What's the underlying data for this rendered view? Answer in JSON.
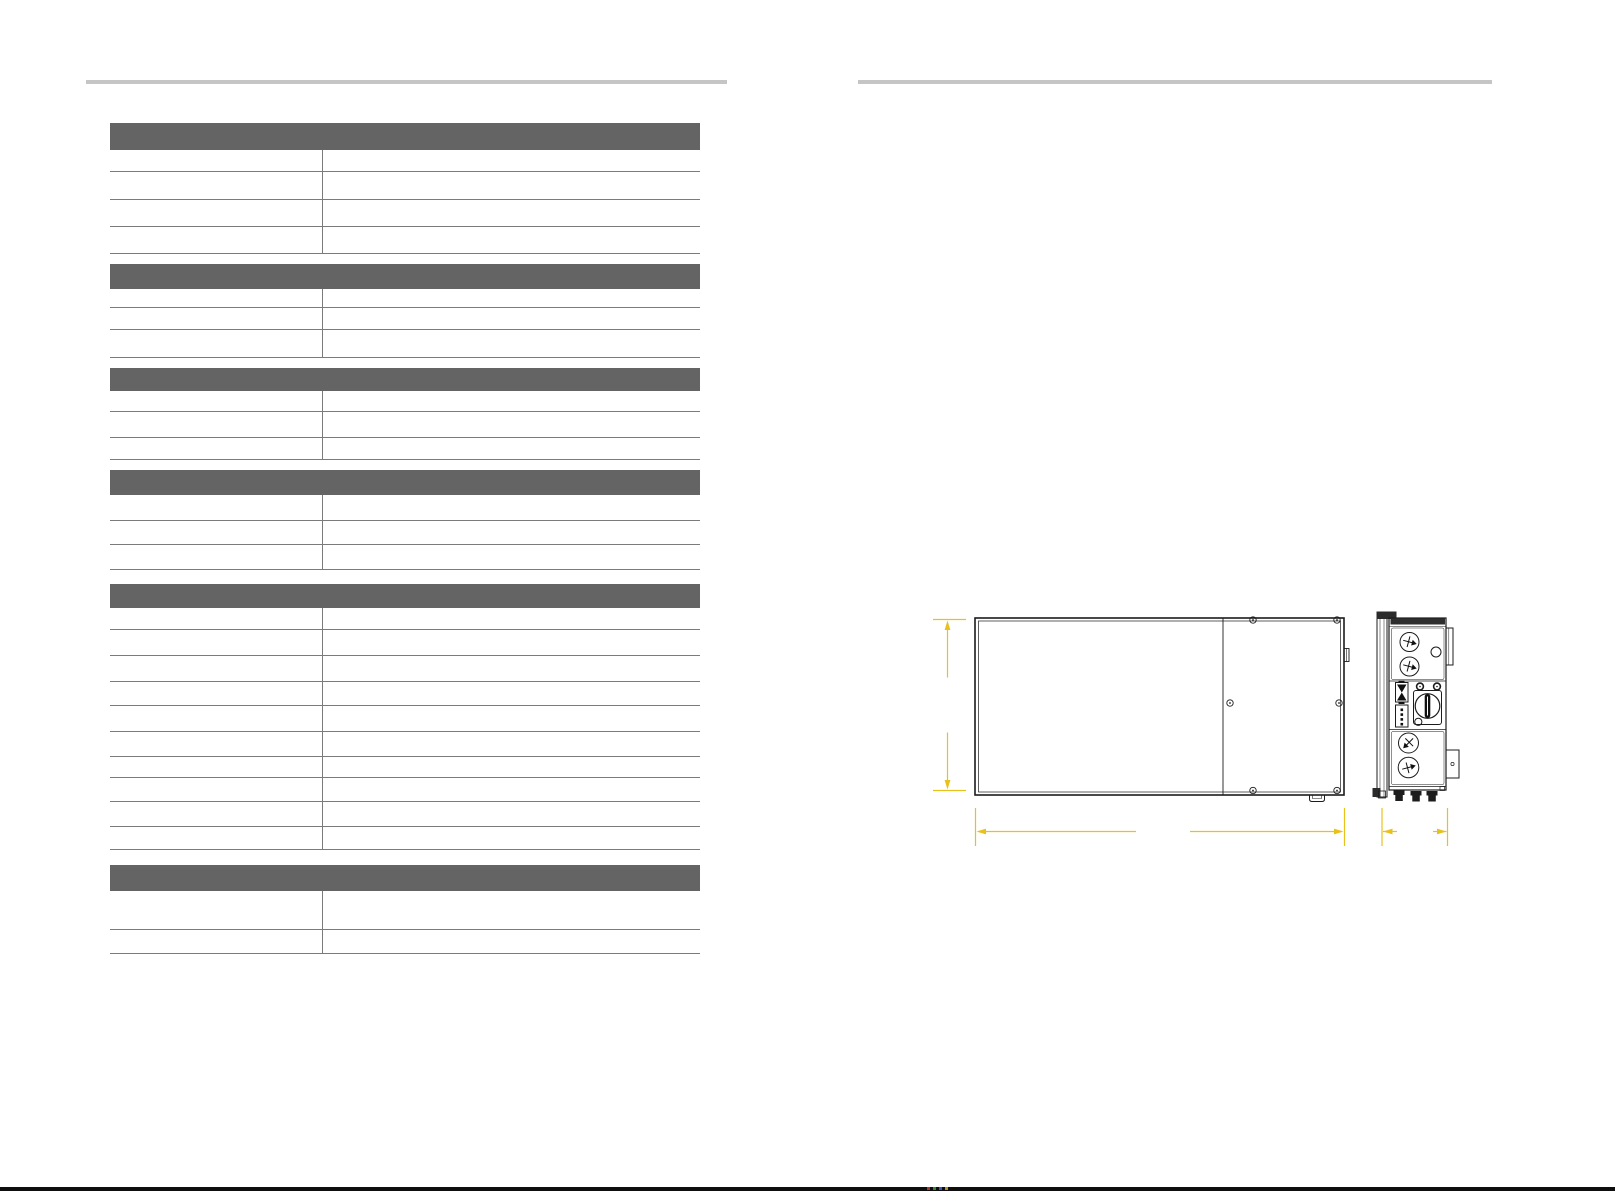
{
  "document": {
    "kind": "product-manual-two-page-spread",
    "visible_text": [],
    "note": "specification table cells are blank (no rendered text); right page shows dimensioned technical drawing"
  },
  "colors": {
    "page_background": "#ffffff",
    "section_bar": "#646464",
    "table_line": "#7b7b7b",
    "page_rule": "#c5c5c5",
    "drawing_stroke": "#1c1c1c",
    "dimension_yellow": "#e9c11b",
    "footer_bar": "#0e0e0e"
  },
  "left_page": {
    "top_rule": {
      "x": 86,
      "y": 80,
      "width": 641
    },
    "table": {
      "x": 110,
      "top": 123,
      "width": 590,
      "divider_offset": 212,
      "sections": [
        {
          "header_height": 27,
          "row_heights": [
            22,
            28,
            27,
            27
          ],
          "gap_below": 10
        },
        {
          "header_height": 25,
          "row_heights": [
            19,
            22,
            28
          ],
          "gap_below": 10
        },
        {
          "header_height": 23,
          "row_heights": [
            21,
            26,
            22
          ],
          "gap_below": 10
        },
        {
          "header_height": 25,
          "row_heights": [
            26,
            24,
            25
          ],
          "gap_below": 14
        },
        {
          "header_height": 24,
          "row_heights": [
            22,
            26,
            26,
            24,
            26,
            25,
            21,
            24,
            25,
            23
          ],
          "gap_below": 15
        },
        {
          "header_height": 26,
          "row_heights": [
            39,
            24
          ],
          "gap_below": 0
        }
      ]
    }
  },
  "right_page": {
    "top_rule": {
      "x": 858,
      "y": 80,
      "width": 634
    },
    "drawing": {
      "views": [
        "front-view",
        "side-view"
      ],
      "front_view_parts": [
        "enclosure",
        "cover-split-line",
        "screws",
        "side-latch",
        "bottom-tab"
      ],
      "side_view_parts": [
        "mounting-rail",
        "body",
        "top-bracket",
        "bottom-bracket",
        "ac-ports",
        "dc-switch-handle",
        "dc-connector",
        "terminal-block",
        "cable-glands"
      ],
      "dimension_lines": [
        "height",
        "width",
        "depth"
      ]
    }
  },
  "footer": {
    "specks": [
      {
        "x": 927,
        "y": 1187,
        "color": "#b03333"
      },
      {
        "x": 933,
        "y": 1187,
        "color": "#2f8a34"
      },
      {
        "x": 939,
        "y": 1187,
        "color": "#3a55c0"
      },
      {
        "x": 945,
        "y": 1187,
        "color": "#c08a2a"
      }
    ]
  }
}
